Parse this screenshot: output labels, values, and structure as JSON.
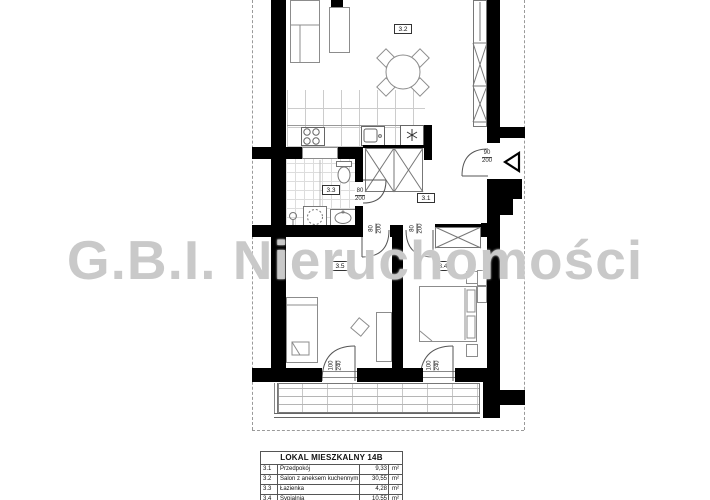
{
  "watermark": {
    "text": "G.B.I. Nieruchomości"
  },
  "rooms": {
    "hall": "3.1",
    "living": "3.2",
    "bath": "3.3",
    "bedroom_right": "3.4",
    "bedroom_left": "3.5"
  },
  "dims": {
    "entrance_door": {
      "w": "90",
      "h": "200"
    },
    "bath_door": {
      "w": "80",
      "h": "200"
    },
    "bedroom_left_door": {
      "w": "80",
      "h": "200"
    },
    "bedroom_right_door": {
      "w": "80",
      "h": "200"
    },
    "window_left": {
      "w": "100",
      "h": "240"
    },
    "window_right": {
      "w": "100",
      "h": "240"
    }
  },
  "table": {
    "title": "LOKAL MIESZKALNY 14B",
    "rows": [
      {
        "no": "3.1",
        "name": "Przedpokój",
        "area": "9,33",
        "unit": "m²"
      },
      {
        "no": "3.2",
        "name": "Salon z aneksem kuchennym",
        "area": "30,55",
        "unit": "m²"
      },
      {
        "no": "3.3",
        "name": "Łazienka",
        "area": "4,28",
        "unit": "m²"
      },
      {
        "no": "3.4",
        "name": "Sypialnia",
        "area": "10,55",
        "unit": "m²"
      },
      {
        "no": "3.5",
        "name": "Sypialnia",
        "area": "12,04",
        "unit": "m²"
      }
    ]
  },
  "icons": {
    "fridge": "snowflake",
    "entrance_marker": "triangle-left"
  },
  "colors": {
    "wall": "#000000",
    "watermark": "#c9c9c9",
    "furniture_stroke": "#8c8c8c"
  }
}
